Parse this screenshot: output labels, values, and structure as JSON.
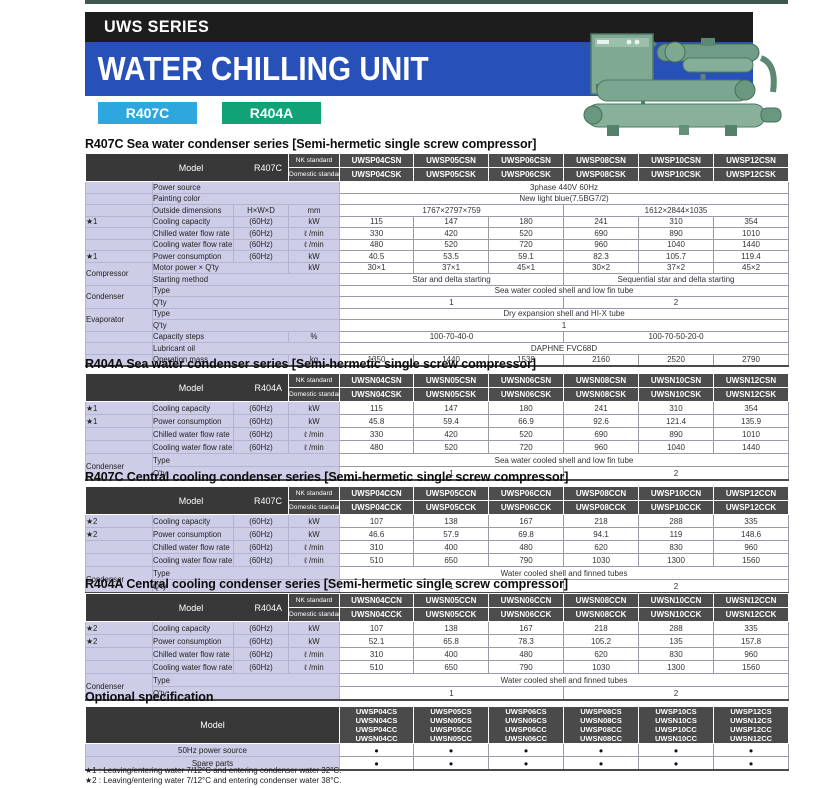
{
  "banner": {
    "series_label": "UWS SERIES",
    "title": "WATER CHILLING UNIT",
    "badges": [
      {
        "label": "R407C",
        "color": "#2ea7de"
      },
      {
        "label": "R404A",
        "color": "#11a277"
      }
    ],
    "colors": {
      "strip": "#3e5751",
      "black_bar": "#1d1d1d",
      "blue_bar": "#2750b8"
    }
  },
  "spec_tables": [
    {
      "title": "R407C Sea water condenser series",
      "title_bracket": "[Semi-hermetic single screw compressor]",
      "model_label": "Model",
      "refrigerant": "R407C",
      "nk_label": "NK standard",
      "domestic_label": "Domestic standard",
      "nk_models": [
        "UWSP04CSN",
        "UWSP05CSN",
        "UWSP06CSN",
        "UWSP08CSN",
        "UWSP10CSN",
        "UWSP12CSN"
      ],
      "domestic_models": [
        "UWSP04CSK",
        "UWSP05CSK",
        "UWSP06CSK",
        "UWSP08CSK",
        "UWSP10CSK",
        "UWSP12CSK"
      ],
      "row_h_class": "rh10",
      "rows": [
        {
          "label": "Power source",
          "span": "all",
          "values": [
            "3phase 440V  60Hz"
          ]
        },
        {
          "label": "Painting color",
          "span": "all",
          "values": [
            "New light blue(7.5BG7/2)"
          ]
        },
        {
          "label": "Outside dimensions",
          "sub": "H×W×D",
          "unit": "mm",
          "span": "half",
          "values": [
            "1767×2797×759",
            "1612×2844×1035"
          ]
        },
        {
          "star": "★1",
          "label": "Cooling capacity",
          "sub": "(60Hz)",
          "unit": "kW",
          "span": "each",
          "values": [
            "115",
            "147",
            "180",
            "241",
            "310",
            "354"
          ]
        },
        {
          "label": "Chilled water flow rate",
          "sub": "(60Hz)",
          "unit": "ℓ /min",
          "span": "each",
          "values": [
            "330",
            "420",
            "520",
            "690",
            "890",
            "1010"
          ]
        },
        {
          "label": "Cooling water flow rate",
          "sub": "(60Hz)",
          "unit": "ℓ /min",
          "span": "each",
          "values": [
            "480",
            "520",
            "720",
            "960",
            "1040",
            "1440"
          ]
        },
        {
          "star": "★1",
          "label": "Power consumption",
          "sub": "(60Hz)",
          "unit": "kW",
          "span": "each",
          "values": [
            "40.5",
            "53.5",
            "59.1",
            "82.3",
            "105.7",
            "119.4"
          ]
        },
        {
          "group": "Compressor",
          "grouprows": 2,
          "label": "Motor power × Q'ty",
          "unit": "kW",
          "span": "each",
          "values": [
            "30×1",
            "37×1",
            "45×1",
            "30×2",
            "37×2",
            "45×2"
          ]
        },
        {
          "ingroup": true,
          "label": "Starting method",
          "span": "half",
          "values": [
            "Star and delta starting",
            "Sequential star and delta starting"
          ]
        },
        {
          "group": "Condenser",
          "grouprows": 2,
          "label": "Type",
          "span": "all",
          "values": [
            "Sea water cooled shell and low fin tube"
          ]
        },
        {
          "ingroup": true,
          "label": "Q'ty",
          "span": "half",
          "values": [
            "1",
            "2"
          ]
        },
        {
          "group": "Evaporator",
          "grouprows": 2,
          "label": "Type",
          "span": "all",
          "values": [
            "Dry expansion shell and HI-X tube"
          ]
        },
        {
          "ingroup": true,
          "label": "Q'ty",
          "span": "all",
          "values": [
            "1"
          ]
        },
        {
          "label": "Capacity steps",
          "unit": "%",
          "span": "half",
          "values": [
            "100-70-40-0",
            "100-70-50-20-0"
          ]
        },
        {
          "label": "Lubricant oil",
          "span": "all",
          "values": [
            "DAPHNE FVC68D"
          ]
        },
        {
          "label": "Operation mass",
          "unit": "kg",
          "span": "each",
          "values": [
            "1350",
            "1440",
            "1530",
            "2160",
            "2520",
            "2790"
          ]
        }
      ]
    },
    {
      "title": "R404A Sea water condenser series",
      "title_bracket": "[Semi-hermetic single screw compressor]",
      "model_label": "Model",
      "refrigerant": "R404A",
      "nk_label": "NK standard",
      "domestic_label": "Domestic standard",
      "nk_models": [
        "UWSN04CSN",
        "UWSN05CSN",
        "UWSN06CSN",
        "UWSN08CSN",
        "UWSN10CSN",
        "UWSN12CSN"
      ],
      "domestic_models": [
        "UWSN04CSK",
        "UWSN05CSK",
        "UWSN06CSK",
        "UWSN08CSK",
        "UWSN10CSK",
        "UWSN12CSK"
      ],
      "row_h_class": "rh12",
      "rows": [
        {
          "star": "★1",
          "label": "Cooling capacity",
          "sub": "(60Hz)",
          "unit": "kW",
          "span": "each",
          "values": [
            "115",
            "147",
            "180",
            "241",
            "310",
            "354"
          ]
        },
        {
          "star": "★1",
          "label": "Power consumption",
          "sub": "(60Hz)",
          "unit": "kW",
          "span": "each",
          "values": [
            "45.8",
            "59.4",
            "66.9",
            "92.6",
            "121.4",
            "135.9"
          ]
        },
        {
          "label": "Chilled water flow rate",
          "sub": "(60Hz)",
          "unit": "ℓ /min",
          "span": "each",
          "values": [
            "330",
            "420",
            "520",
            "690",
            "890",
            "1010"
          ]
        },
        {
          "label": "Cooling water flow rate",
          "sub": "(60Hz)",
          "unit": "ℓ /min",
          "span": "each",
          "values": [
            "480",
            "520",
            "720",
            "960",
            "1040",
            "1440"
          ]
        },
        {
          "group": "Condenser",
          "grouprows": 2,
          "label": "Type",
          "span": "all",
          "values": [
            "Sea water cooled shell and low fin tube"
          ]
        },
        {
          "ingroup": true,
          "label": "Q'ty",
          "span": "half",
          "values": [
            "1",
            "2"
          ]
        }
      ]
    },
    {
      "title": "R407C Central cooling condenser series",
      "title_bracket": "[Semi-hermetic single screw compressor]",
      "model_label": "Model",
      "refrigerant": "R407C",
      "nk_label": "NK standard",
      "domestic_label": "Domestic standard",
      "nk_models": [
        "UWSP04CCN",
        "UWSP05CCN",
        "UWSP06CCN",
        "UWSP08CCN",
        "UWSP10CCN",
        "UWSP12CCN"
      ],
      "domestic_models": [
        "UWSP04CCK",
        "UWSP05CCK",
        "UWSP06CCK",
        "UWSP08CCK",
        "UWSP10CCK",
        "UWSP12CCK"
      ],
      "row_h_class": "rh12",
      "rows": [
        {
          "star": "★2",
          "label": "Cooling capacity",
          "sub": "(60Hz)",
          "unit": "kW",
          "span": "each",
          "values": [
            "107",
            "138",
            "167",
            "218",
            "288",
            "335"
          ]
        },
        {
          "star": "★2",
          "label": "Power consumption",
          "sub": "(60Hz)",
          "unit": "kW",
          "span": "each",
          "values": [
            "46.6",
            "57.9",
            "69.8",
            "94.1",
            "119",
            "148.6"
          ]
        },
        {
          "label": "Chilled water flow rate",
          "sub": "(60Hz)",
          "unit": "ℓ /min",
          "span": "each",
          "values": [
            "310",
            "400",
            "480",
            "620",
            "830",
            "960"
          ]
        },
        {
          "label": "Cooling water flow rate",
          "sub": "(60Hz)",
          "unit": "ℓ /min",
          "span": "each",
          "values": [
            "510",
            "650",
            "790",
            "1030",
            "1300",
            "1560"
          ]
        },
        {
          "group": "Condenser",
          "grouprows": 2,
          "label": "Type",
          "span": "all",
          "values": [
            "Water cooled shell and finned tubes"
          ]
        },
        {
          "ingroup": true,
          "label": "Q'ty",
          "span": "half",
          "values": [
            "1",
            "2"
          ]
        }
      ]
    },
    {
      "title": "R404A Central cooling condenser series",
      "title_bracket": "[Semi-hermetic single screw compressor]",
      "model_label": "Model",
      "refrigerant": "R404A",
      "nk_label": "NK standard",
      "domestic_label": "Domestic standard",
      "nk_models": [
        "UWSN04CCN",
        "UWSN05CCN",
        "UWSN06CCN",
        "UWSN08CCN",
        "UWSN10CCN",
        "UWSN12CCN"
      ],
      "domestic_models": [
        "UWSN04CCK",
        "UWSN05CCK",
        "UWSN06CCK",
        "UWSN08CCK",
        "UWSN10CCK",
        "UWSN12CCK"
      ],
      "row_h_class": "rh12",
      "rows": [
        {
          "star": "★2",
          "label": "Cooling capacity",
          "sub": "(60Hz)",
          "unit": "kW",
          "span": "each",
          "values": [
            "107",
            "138",
            "167",
            "218",
            "288",
            "335"
          ]
        },
        {
          "star": "★2",
          "label": "Power consumption",
          "sub": "(60Hz)",
          "unit": "kW",
          "span": "each",
          "values": [
            "52.1",
            "65.8",
            "78.3",
            "105.2",
            "135",
            "157.8"
          ]
        },
        {
          "label": "Chilled water flow rate",
          "sub": "(60Hz)",
          "unit": "ℓ /min",
          "span": "each",
          "values": [
            "310",
            "400",
            "480",
            "620",
            "830",
            "960"
          ]
        },
        {
          "label": "Cooling water flow rate",
          "sub": "(60Hz)",
          "unit": "ℓ /min",
          "span": "each",
          "values": [
            "510",
            "650",
            "790",
            "1030",
            "1300",
            "1560"
          ]
        },
        {
          "group": "Condenser",
          "grouprows": 2,
          "label": "Type",
          "span": "all",
          "values": [
            "Water cooled shell and finned tubes"
          ]
        },
        {
          "ingroup": true,
          "label": "Q'ty",
          "span": "half",
          "values": [
            "1",
            "2"
          ]
        }
      ]
    }
  ],
  "optional": {
    "title": "Optional specification",
    "model_label": "Model",
    "columns": [
      [
        "UWSP04CS",
        "UWSN04CS",
        "UWSP04CC",
        "UWSN04CC"
      ],
      [
        "UWSP05CS",
        "UWSN05CS",
        "UWSP05CC",
        "UWSN05CC"
      ],
      [
        "UWSP06CS",
        "UWSN06CS",
        "UWSP06CC",
        "UWSN06CC"
      ],
      [
        "UWSP08CS",
        "UWSN08CS",
        "UWSP08CC",
        "UWSN08CC"
      ],
      [
        "UWSP10CS",
        "UWSN10CS",
        "UWSP10CC",
        "UWSN10CC"
      ],
      [
        "UWSP12CS",
        "UWSN12CS",
        "UWSP12CC",
        "UWSN12CC"
      ]
    ],
    "rows": [
      {
        "label": "50Hz power source",
        "dot": "●"
      },
      {
        "label": "Spare parts",
        "dot": "●"
      }
    ]
  },
  "footnotes": [
    "★1 : Leaving/entering water 7/12°C and entering condenser water 32°C.",
    "★2 : Leaving/entering water 7/12°C and entering condenser water 38°C."
  ]
}
